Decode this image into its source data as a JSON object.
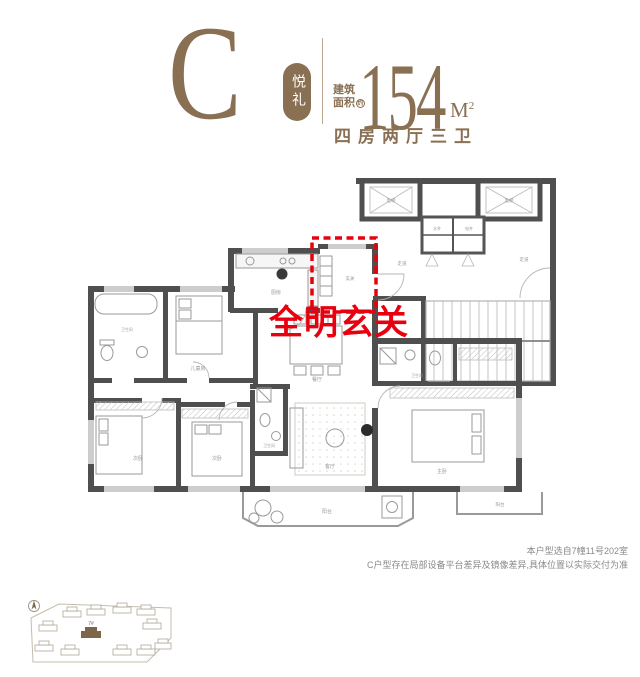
{
  "header": {
    "unit_letter": "C",
    "unit_name": "悦礼",
    "area_prefix_line1": "建筑",
    "area_prefix_line2": "面积",
    "area_approx": "约",
    "area_value": "154",
    "area_unit_m": "M",
    "area_unit_sup": "2",
    "layout_text": "四房两厅三卫"
  },
  "callout": {
    "text": "全明玄关"
  },
  "plan": {
    "rooms": {
      "entry": "玄关",
      "kitchen": "厨房",
      "dining": "餐厅",
      "living": "客厅",
      "balcony_main": "阳台",
      "balcony_master": "阳台",
      "master": "主卧",
      "bedroom_a": "次卧",
      "bedroom_b": "次卧",
      "kids": "儿童房",
      "bath_main": "卫生间",
      "bath_second": "卫生间",
      "bath_master": "卫生间",
      "elevator_left": "电梯",
      "elevator_right": "电梯",
      "corridor_left": "走道",
      "corridor_right": "走道",
      "shaft_water": "水井",
      "shaft_elec": "电井"
    }
  },
  "notes": {
    "line1": "本户型选自7幢11号202室",
    "line2": "C户型存在局部设备平台差异及镜像差异,具体位置以实际交付为准"
  },
  "siteplan": {
    "highlight_label": "7#"
  },
  "colors": {
    "brand_brown": "#8a7053",
    "accent_red": "#e8000f",
    "wall_gray": "#4f4f4f",
    "line_gray": "#b5b5b5",
    "note_gray": "#8a8a8a"
  }
}
